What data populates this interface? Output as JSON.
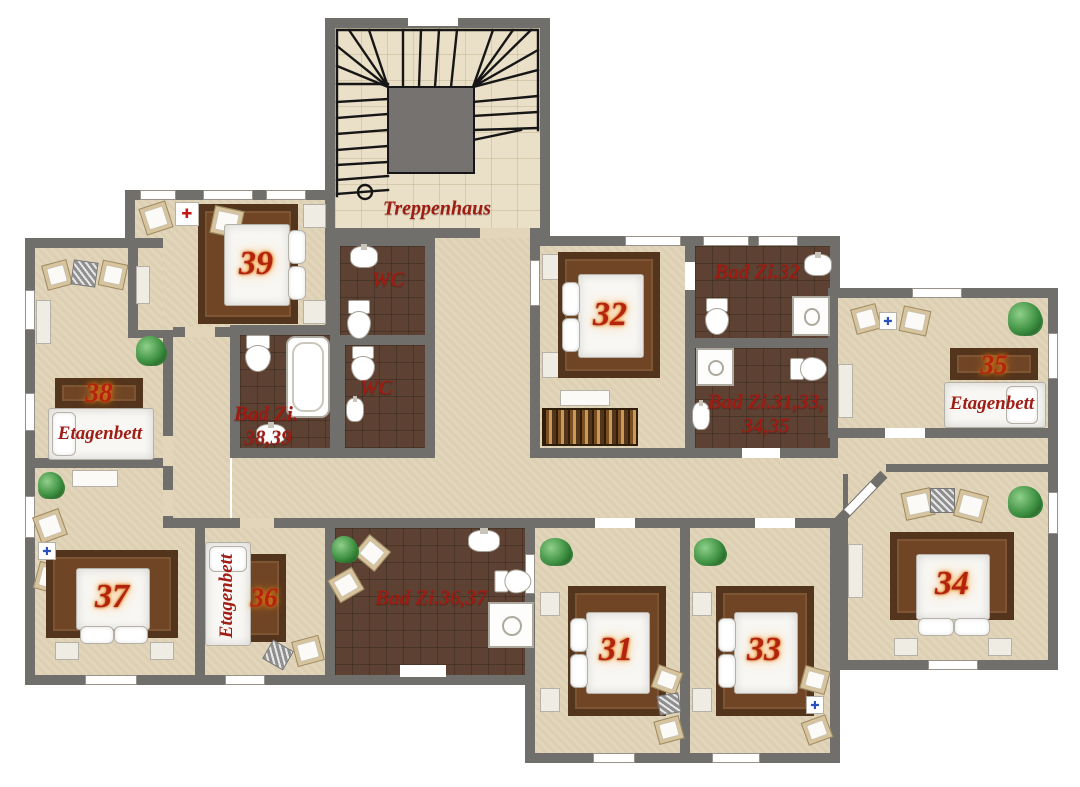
{
  "title": "Etagenplan Obergeschoss",
  "colors": {
    "wall": "#716f6c",
    "floor": "#e2d5ba",
    "stair_floor": "#eadfc7",
    "bath_tile": "#5d4233",
    "bed_rug": "#53341c",
    "bed_rug_inner": "#6f4526",
    "label_red": "#a01d15",
    "number_red": "#b3230f",
    "number_glow": "#ff8c1a",
    "plant_green": "#2e7d32",
    "wardrobe_wood": "#7a4e20"
  },
  "rooms": {
    "treppenhaus": {
      "label": "Treppenhaus"
    },
    "room39": {
      "number": "39"
    },
    "room38": {
      "number": "38",
      "bed_label": "Etagenbett"
    },
    "room37": {
      "number": "37"
    },
    "room36": {
      "number": "36",
      "bed_label": "Etagenbett"
    },
    "room35": {
      "number": "35",
      "bed_label": "Etagenbett"
    },
    "room34": {
      "number": "34"
    },
    "room33": {
      "number": "33"
    },
    "room32": {
      "number": "32"
    },
    "room31": {
      "number": "31"
    },
    "wc_upper": {
      "label": "WC"
    },
    "wc_lower": {
      "label": "WC"
    },
    "bad_38_39": {
      "label_line1": "Bad Zi.",
      "label_line2": "38,39"
    },
    "bad_32": {
      "label": "Bad Zi.32"
    },
    "bad_31_33_34_35": {
      "label_line1": "Bad Zi.31,33,",
      "label_line2": "34,35"
    },
    "bad_36_37": {
      "label": "Bad Zi.36,37"
    }
  }
}
